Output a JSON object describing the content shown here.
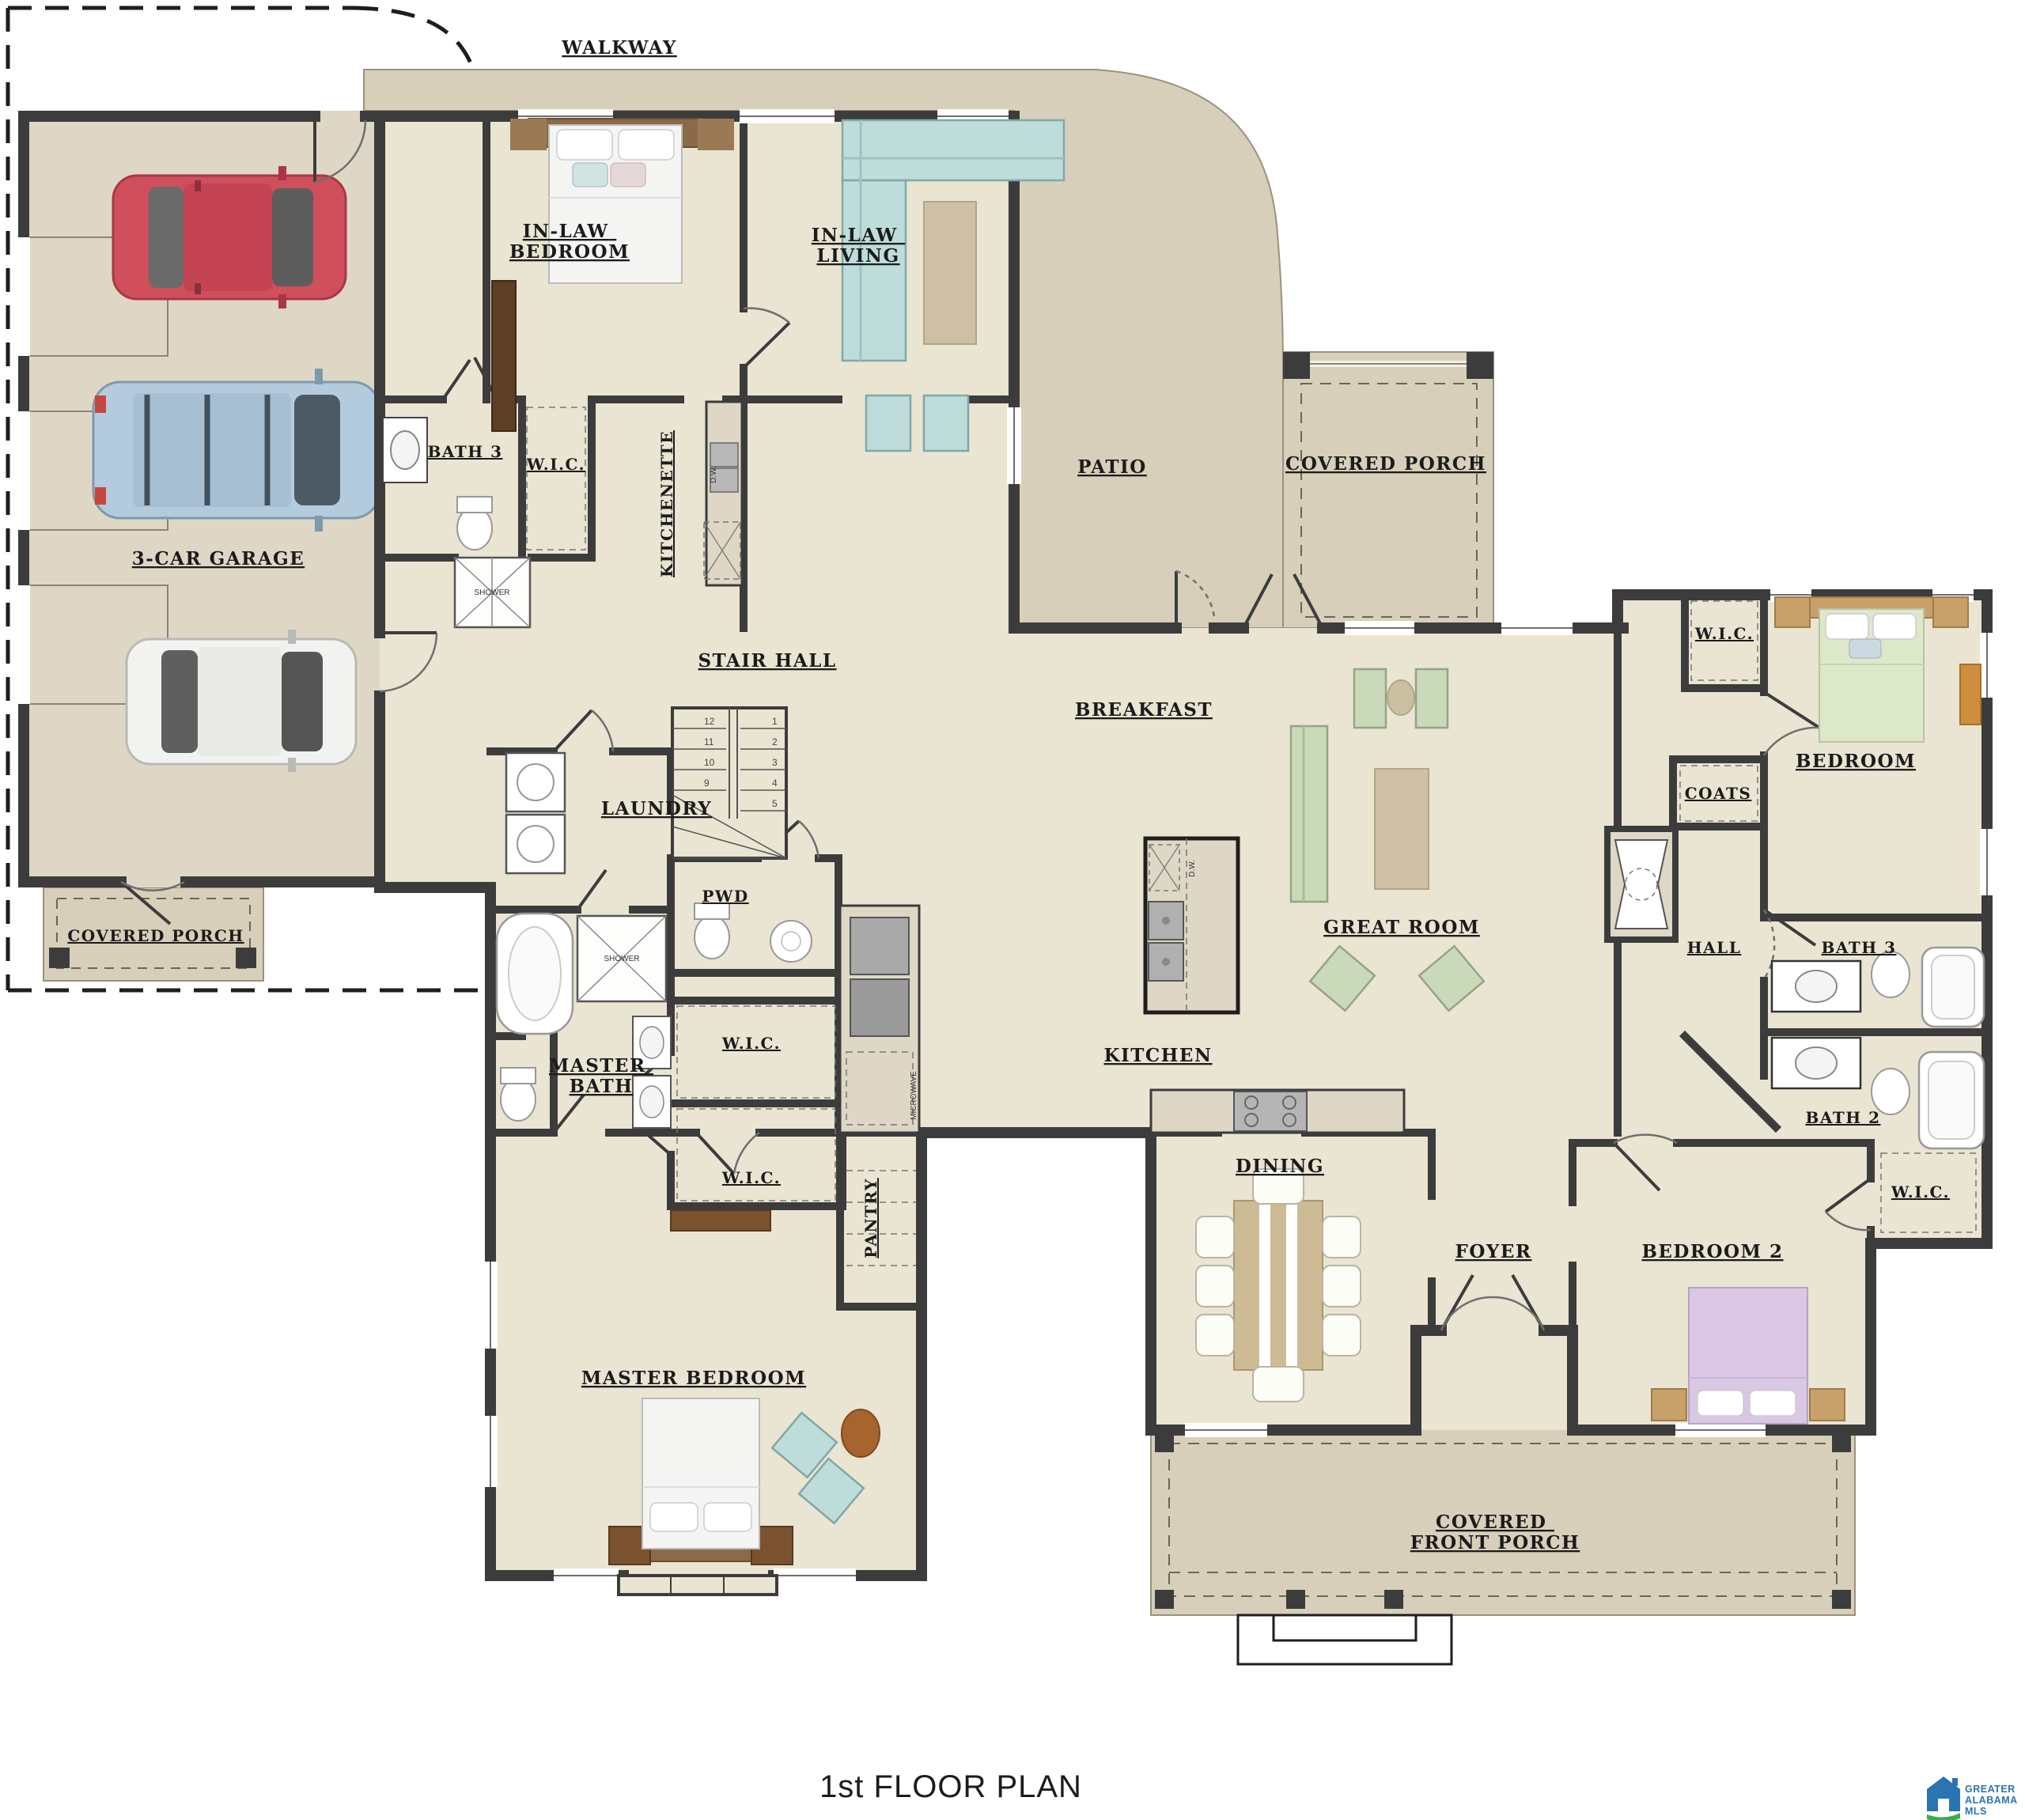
{
  "title": "1st FLOOR PLAN",
  "logo": {
    "line1": "GREATER",
    "line2": "ALABAMA",
    "line3": "MLS"
  },
  "palette": {
    "wall": "#3c3c3c",
    "floor_interior": "#eae4d2",
    "floor_garage": "#ded7c5",
    "floor_outdoor": "#d8cfba",
    "furniture_green": "#c9d9ba",
    "furniture_teal": "#bedcda",
    "wood": "#c79c62",
    "wood_dark": "#7a5230",
    "rug": "#cec0a4",
    "car_red": "#cf4f5d",
    "car_blue": "#b4cbdd",
    "car_white": "#f2f2f0",
    "logo_blue": "#2b74b2",
    "logo_green": "#3faa4c"
  },
  "rooms": {
    "walkway": "WALKWAY",
    "in_law_bedroom": [
      "IN-LAW",
      "BEDROOM"
    ],
    "in_law_living": [
      "IN-LAW",
      "LIVING"
    ],
    "bath3_inlaw": "BATH 3",
    "wic_inlaw": "W.I.C.",
    "kitchenette": "KITCHENETTE",
    "patio": "PATIO",
    "covered_porch_right": "COVERED PORCH",
    "garage": "3-CAR GARAGE",
    "stair_hall": "STAIR HALL",
    "breakfast": "BREAKFAST",
    "wic_bedroom": "W.I.C.",
    "bedroom": "BEDROOM",
    "coats": "COATS",
    "laundry": "LAUNDRY",
    "pwd": "PWD",
    "great_room": "GREAT ROOM",
    "hall": "HALL",
    "bath3_right": "BATH 3",
    "master_bath": [
      "MASTER",
      "BATH"
    ],
    "wic_master_top": "W.I.C.",
    "wic_master_bottom": "W.I.C.",
    "kitchen": "KITCHEN",
    "bath2": "BATH 2",
    "wic_bedroom2": "W.I.C.",
    "pantry": "PANTRY",
    "dining": "DINING",
    "foyer": "FOYER",
    "bedroom2": "BEDROOM 2",
    "covered_porch_left": "COVERED PORCH",
    "master_bedroom": "MASTER BEDROOM",
    "covered_front_porch": [
      "COVERED",
      "FRONT PORCH"
    ]
  },
  "annotations": {
    "shower_inlaw": "SHOWER",
    "shower_master": "SHOWER",
    "dw_kitchenette": "D.W.",
    "dw_island": "D.W.",
    "microwave": "MICROWAVE",
    "stair_numbers_right": [
      "1",
      "2",
      "3",
      "4",
      "5"
    ],
    "stair_numbers_left": [
      "12",
      "11",
      "10",
      "9"
    ]
  }
}
